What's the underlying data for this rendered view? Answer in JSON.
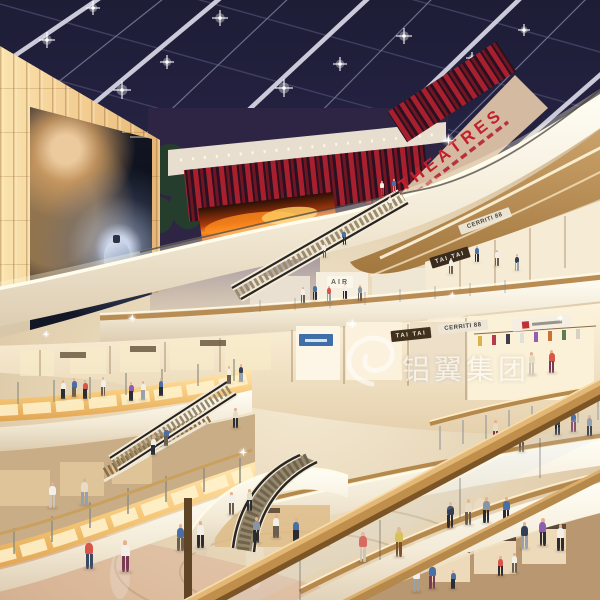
{
  "scene": {
    "description": "Architectural rendering of a multi-level shopping mall atrium with skylight, curved balconies, escalators and shoppers",
    "width": 600,
    "height": 600
  },
  "signs": {
    "theatres": "THEATRES",
    "tai_tai_upper": "TAI TAI",
    "tai_tai_lower": "TAI TAI",
    "air": "AIR",
    "cerriti_upper": "CERRITI 88",
    "cerriti_lower": "CERRITI 88"
  },
  "billboard": {
    "brand": "GUERLAIN"
  },
  "watermark": {
    "text": "铝翼集团"
  },
  "colors": {
    "ceiling_navy": "#23233f",
    "theatre_red": "#c2202e",
    "slat_red": "#a8202e",
    "fascia_white": "#fdf9ee",
    "wood": "#b98c54",
    "amber_glow": "#f6c878",
    "floor": "#e2d1b4",
    "screen_flame": "#ff8c1e"
  },
  "people": {
    "skin": "#e5b18c",
    "shirts": [
      "#f2efe8",
      "#d85548",
      "#4a6fa5",
      "#333f55",
      "#8a94a2",
      "#8e5fb0",
      "#e7dcc6",
      "#d8c05a"
    ],
    "pants": [
      "#3b4a63",
      "#6b5d4f",
      "#96a1ad",
      "#2c2c34",
      "#7a5230",
      "#cdc5b8",
      "#7a3b55"
    ],
    "figures": [
      [
        84,
        538,
        1.15,
        1,
        0
      ],
      [
        120,
        540,
        1.2,
        0,
        6
      ],
      [
        176,
        524,
        1.0,
        2,
        1
      ],
      [
        196,
        521,
        1.0,
        0,
        3
      ],
      [
        252,
        517,
        0.95,
        4,
        3
      ],
      [
        272,
        514,
        0.9,
        0,
        1
      ],
      [
        292,
        518,
        0.9,
        2,
        3
      ],
      [
        358,
        532,
        1.1,
        1,
        5
      ],
      [
        394,
        527,
        1.1,
        7,
        4
      ],
      [
        446,
        502,
        0.95,
        3,
        3
      ],
      [
        464,
        499,
        0.95,
        6,
        1
      ],
      [
        482,
        497,
        0.95,
        4,
        3
      ],
      [
        502,
        497,
        0.95,
        2,
        3
      ],
      [
        520,
        522,
        1.0,
        3,
        2
      ],
      [
        538,
        518,
        1.05,
        5,
        3
      ],
      [
        556,
        524,
        1.0,
        0,
        3
      ],
      [
        228,
        492,
        0.85,
        0,
        1
      ],
      [
        246,
        489,
        0.8,
        6,
        3
      ],
      [
        412,
        566,
        0.95,
        0,
        2
      ],
      [
        428,
        563,
        0.95,
        2,
        6
      ],
      [
        497,
        556,
        0.75,
        1,
        3
      ],
      [
        511,
        553,
        0.75,
        0,
        1
      ],
      [
        450,
        570,
        0.7,
        2,
        3
      ],
      [
        48,
        482,
        0.95,
        0,
        5
      ],
      [
        80,
        478,
        1.0,
        6,
        2
      ],
      [
        60,
        380,
        0.7,
        0,
        3
      ],
      [
        71,
        378,
        0.7,
        2,
        1
      ],
      [
        82,
        380,
        0.7,
        1,
        3
      ],
      [
        100,
        377,
        0.72,
        0,
        1
      ],
      [
        128,
        382,
        0.7,
        5,
        3
      ],
      [
        140,
        381,
        0.7,
        0,
        2
      ],
      [
        158,
        378,
        0.68,
        2,
        3
      ],
      [
        226,
        366,
        0.65,
        0,
        1
      ],
      [
        238,
        364,
        0.65,
        3,
        2
      ],
      [
        300,
        287,
        0.6,
        0,
        1
      ],
      [
        312,
        284,
        0.6,
        2,
        3
      ],
      [
        326,
        286,
        0.6,
        1,
        2
      ],
      [
        342,
        283,
        0.6,
        0,
        3
      ],
      [
        357,
        285,
        0.6,
        4,
        1
      ],
      [
        474,
        246,
        0.6,
        2,
        3
      ],
      [
        494,
        250,
        0.6,
        0,
        1
      ],
      [
        514,
        254,
        0.62,
        3,
        2
      ],
      [
        448,
        258,
        0.6,
        0,
        1
      ],
      [
        322,
        243,
        0.55,
        0,
        1
      ],
      [
        342,
        230,
        0.55,
        2,
        3
      ],
      [
        388,
        196,
        0.5,
        0,
        2
      ],
      [
        380,
        181,
        0.5,
        0,
        1
      ],
      [
        392,
        179,
        0.5,
        2,
        2
      ],
      [
        150,
        436,
        0.7,
        0,
        3
      ],
      [
        163,
        427,
        0.7,
        2,
        1
      ],
      [
        232,
        408,
        0.75,
        6,
        3
      ],
      [
        492,
        420,
        0.8,
        6,
        6
      ],
      [
        554,
        414,
        0.78,
        3,
        3
      ],
      [
        570,
        411,
        0.78,
        2,
        6
      ],
      [
        586,
        415,
        0.78,
        4,
        3
      ],
      [
        518,
        432,
        0.75,
        0,
        1
      ],
      [
        528,
        352,
        0.85,
        6,
        5
      ],
      [
        548,
        350,
        0.85,
        1,
        6
      ]
    ]
  },
  "lights": {
    "ceiling_bursts": [
      [
        47,
        40,
        8
      ],
      [
        93,
        8,
        7
      ],
      [
        122,
        90,
        9
      ],
      [
        167,
        62,
        7
      ],
      [
        220,
        18,
        8
      ],
      [
        284,
        88,
        9
      ],
      [
        340,
        64,
        7
      ],
      [
        404,
        36,
        8
      ],
      [
        302,
        138,
        7
      ],
      [
        362,
        116,
        6
      ],
      [
        430,
        90,
        6
      ],
      [
        246,
        156,
        6
      ],
      [
        187,
        128,
        5
      ],
      [
        472,
        58,
        6
      ],
      [
        524,
        30,
        6
      ]
    ],
    "sparkles": [
      [
        448,
        140,
        7
      ],
      [
        352,
        324,
        6
      ],
      [
        132,
        318,
        5
      ],
      [
        452,
        295,
        4
      ],
      [
        46,
        334,
        4
      ],
      [
        243,
        452,
        5
      ],
      [
        560,
        318,
        4
      ]
    ]
  }
}
